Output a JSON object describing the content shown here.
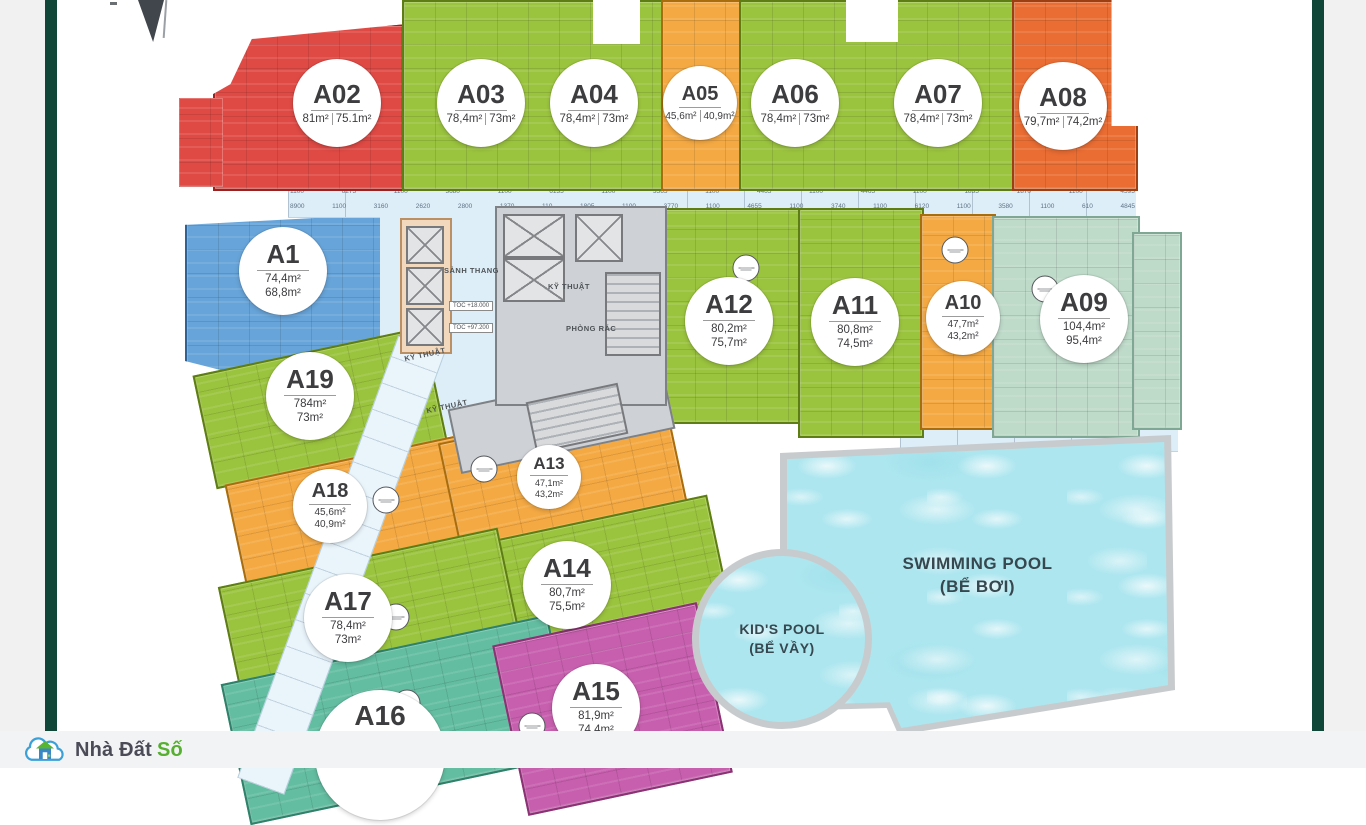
{
  "palette": {
    "red": "#e04a45",
    "green": "#9bc43e",
    "orange": "#f4a943",
    "vermilion": "#ea6d33",
    "blue": "#67a4d9",
    "celadon": "#bedac9",
    "teal": "#63bda1",
    "magenta": "#c75fae",
    "pool": "#ade6ef",
    "walkway": "#ddeef8",
    "accent_bar": "#0f4638",
    "logo_green": "#55b02f"
  },
  "plan": {
    "units": [
      {
        "id": "A02",
        "area1": "81m²",
        "area2": "75.1m²"
      },
      {
        "id": "A03",
        "area1": "78,4m²",
        "area2": "73m²"
      },
      {
        "id": "A04",
        "area1": "78,4m²",
        "area2": "73m²"
      },
      {
        "id": "A05",
        "area1": "45,6m²",
        "area2": "40,9m²"
      },
      {
        "id": "A06",
        "area1": "78,4m²",
        "area2": "73m²"
      },
      {
        "id": "A07",
        "area1": "78,4m²",
        "area2": "73m²"
      },
      {
        "id": "A08",
        "area1": "79,7m²",
        "area2": "74,2m²"
      },
      {
        "id": "A1",
        "area1": "74,4m²",
        "area2": "68,8m²"
      },
      {
        "id": "A12",
        "area1": "80,2m²",
        "area2": "75,7m²"
      },
      {
        "id": "A11",
        "area1": "80,8m²",
        "area2": "74,5m²"
      },
      {
        "id": "A10",
        "area1": "47,7m²",
        "area2": "43,2m²"
      },
      {
        "id": "A09",
        "area1": "104,4m²",
        "area2": "95,4m²"
      },
      {
        "id": "A19",
        "area1": "784m²",
        "area2": "73m²"
      },
      {
        "id": "A18",
        "area1": "45,6m²",
        "area2": "40,9m²"
      },
      {
        "id": "A13",
        "area1": "47,1m²",
        "area2": "43,2m²"
      },
      {
        "id": "A14",
        "area1": "80,7m²",
        "area2": "75,5m²"
      },
      {
        "id": "A17",
        "area1": "78,4m²",
        "area2": "73m²"
      },
      {
        "id": "A16",
        "area1": "",
        "area2": ""
      },
      {
        "id": "A15",
        "area1": "81,9m²",
        "area2": "74,4m²"
      }
    ],
    "labels": {
      "lobby": "SẢNH THANG",
      "technical": "KỸ THUẬT",
      "garbage": "PHÒNG RÁC",
      "toc_upper": "TOC +18.000",
      "toc_lower": "TOC +97.200"
    },
    "pools": {
      "swimming": {
        "line1": "SWIMMING POOL",
        "line2": "(BỂ BƠI)"
      },
      "kids": {
        "line1": "KID'S POOL",
        "line2": "(BỂ VẦY)"
      }
    },
    "dimensions": {
      "row1": [
        "1100",
        "6275",
        "1100",
        "3680",
        "1100",
        "6135",
        "1100",
        "3565",
        "1100",
        "4465",
        "1100",
        "4465",
        "1100",
        "1835",
        "1870",
        "1100",
        "4595"
      ],
      "row2": [
        "8900",
        "1100",
        "3160",
        "2620",
        "2800",
        "1370",
        "110",
        "1805",
        "1100",
        "3770",
        "1100",
        "4655",
        "1100",
        "3740",
        "1100",
        "6120",
        "1100",
        "3580",
        "1100",
        "610",
        "4845"
      ]
    }
  },
  "brand": {
    "name_dark": "Nhà Đất",
    "name_accent": "Số"
  }
}
